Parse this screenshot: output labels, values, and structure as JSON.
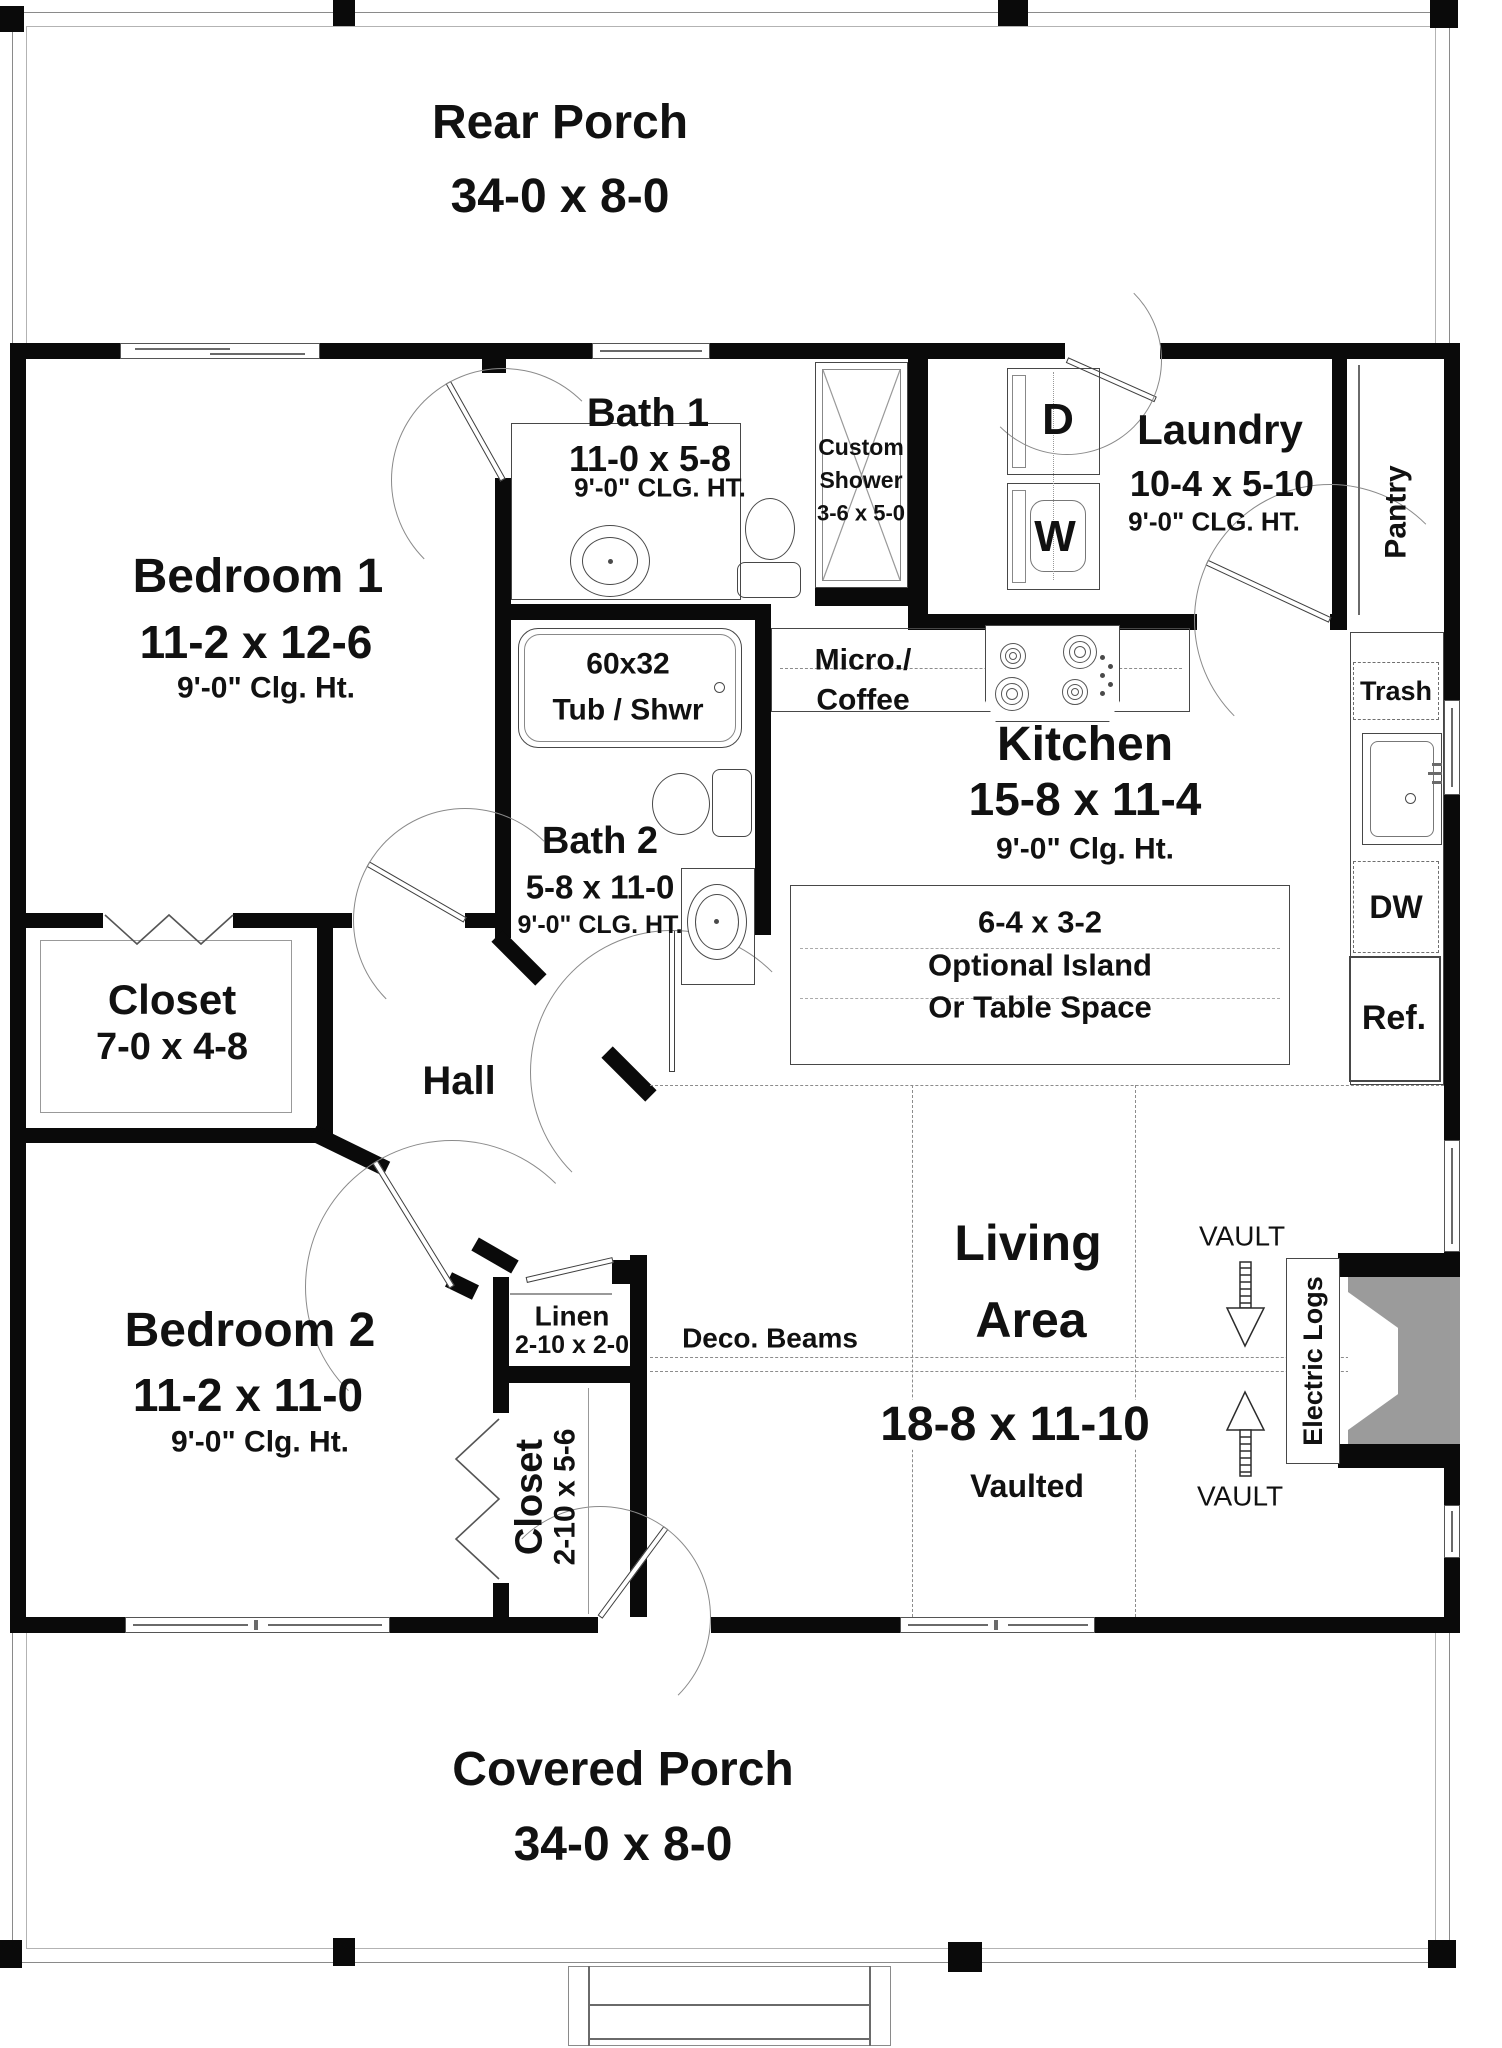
{
  "rooms": {
    "rear_porch": {
      "name": "Rear Porch",
      "dims": "34-0 x 8-0"
    },
    "covered_porch": {
      "name": "Covered Porch",
      "dims": "34-0 x 8-0"
    },
    "bedroom1": {
      "name": "Bedroom 1",
      "dims": "11-2 x 12-6",
      "ceiling": "9'-0\" Clg. Ht."
    },
    "bedroom2": {
      "name": "Bedroom 2",
      "dims": "11-2 x 11-0",
      "ceiling": "9'-0\" Clg. Ht."
    },
    "bath1": {
      "name": "Bath 1",
      "dims": "11-0 x 5-8",
      "ceiling": "9'-0\" CLG. HT."
    },
    "bath2": {
      "name": "Bath 2",
      "dims": "5-8 x 11-0",
      "ceiling": "9'-0\" CLG. HT."
    },
    "laundry": {
      "name": "Laundry",
      "dims": "10-4 x 5-10",
      "ceiling": "9'-0\" CLG. HT."
    },
    "kitchen": {
      "name": "Kitchen",
      "dims": "15-8 x 11-4",
      "ceiling": "9'-0\" Clg. Ht."
    },
    "living": {
      "name_line1": "Living",
      "name_line2": "Area",
      "dims": "18-8 x 11-10",
      "note": "Vaulted"
    },
    "hall": {
      "name": "Hall"
    },
    "closet1": {
      "name": "Closet",
      "dims": "7-0 x 4-8"
    },
    "closet2": {
      "name": "Closet",
      "dims": "2-10 x 5-6"
    },
    "linen": {
      "name": "Linen",
      "dims": "2-10 x 2-0"
    },
    "pantry": {
      "name": "Pantry"
    }
  },
  "features": {
    "custom_shower": {
      "line1": "Custom",
      "line2": "Shower",
      "dims": "3-6 x 5-0"
    },
    "tub": {
      "line1": "60x32",
      "line2": "Tub / Shwr"
    },
    "micro_coffee": {
      "line1": "Micro./",
      "line2": "Coffee"
    },
    "island": {
      "dims": "6-4 x 3-2",
      "line2": "Optional Island",
      "line3": "Or Table Space"
    },
    "deco_beams": "Deco. Beams",
    "vault": "VAULT",
    "electric_logs": "Electric Logs",
    "washer": "W",
    "dryer": "D",
    "dishwasher": "DW",
    "refrigerator": "Ref.",
    "trash": "Trash"
  },
  "colors": {
    "wall": "#0a0a0a",
    "thin_line": "#474747",
    "fireplace_gray": "#9b9b9b",
    "porch_line": "#8a8a8a"
  }
}
